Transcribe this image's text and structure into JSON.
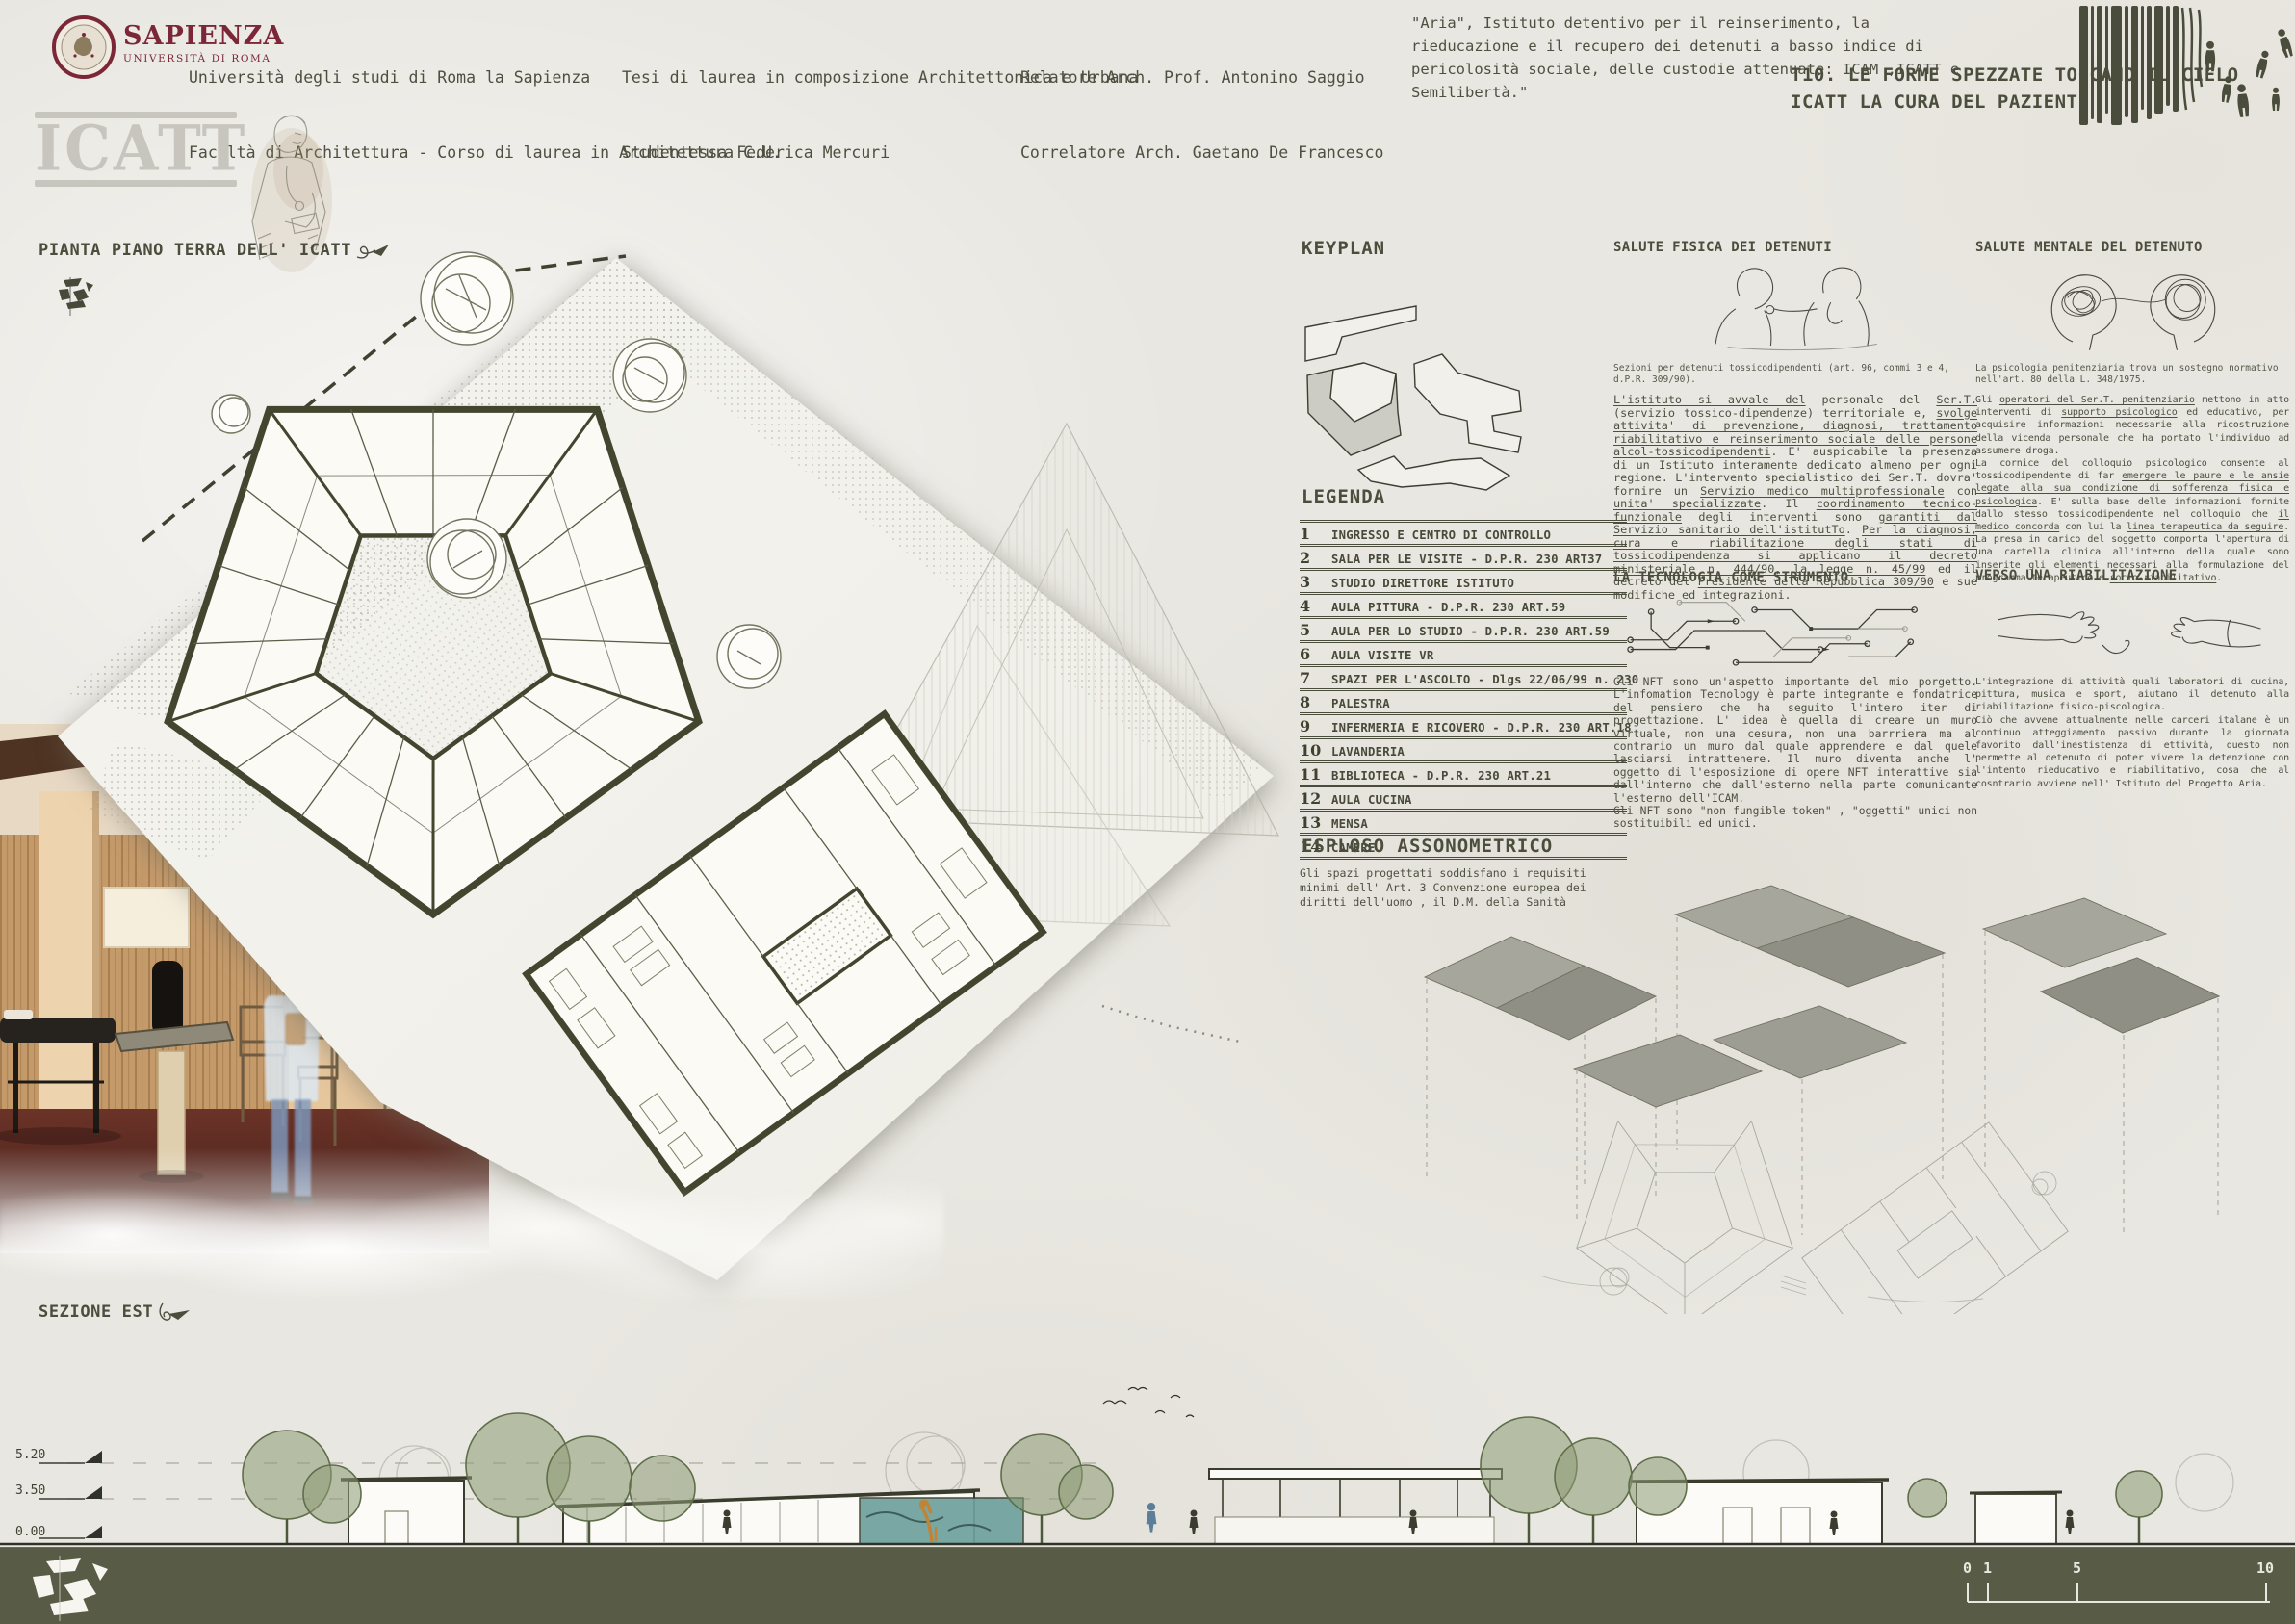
{
  "header": {
    "logo": {
      "name": "SAPIENZA",
      "subtitle": "UNIVERSITÀ DI ROMA"
    },
    "university_line1": "Università degli studi di Roma la Sapienza",
    "university_line2": "Facoltà di Architettura - Corso di laurea in Architettura C.U.",
    "thesis_line1": "Tesi di laurea in composizione Architettonica e Urbana",
    "thesis_line2": "Studentessa Federica Mercuri",
    "advisor_line1": "Relatore Arch. Prof. Antonino Saggio",
    "advisor_line2": "Correlatore Arch. Gaetano De Francesco",
    "quote": "\"Aria\",  Istituto detentivo per il reinserimento, la rieducazione  e il recupero dei detenuti a basso indice di pericolosità sociale, delle custodie attenuate: ICAM ,ICATT e Semilibertà.\"",
    "board_title_line1": "T10. LE FORME SPEZZATE TOCCANO IL CIELO",
    "board_title_line2": "ICATT LA CURA DEL PAZIENTE"
  },
  "branding": {
    "project_logo": "ICATT"
  },
  "plan": {
    "title": "PIANTA PIANO TERRA DELL' ICATT"
  },
  "keyplan": {
    "title": "KEYPLAN"
  },
  "legend": {
    "title": "LEGENDA",
    "items": [
      {
        "num": "1",
        "label": "INGRESSO E CENTRO DI CONTROLLO"
      },
      {
        "num": "2",
        "label": "SALA PER LE VISITE - D.P.R. 230 ART37"
      },
      {
        "num": "3",
        "label": "STUDIO DIRETTORE ISTITUTO"
      },
      {
        "num": "4",
        "label": "AULA PITTURA - D.P.R. 230 ART.59"
      },
      {
        "num": "5",
        "label": "AULA PER LO STUDIO - D.P.R. 230 ART.59"
      },
      {
        "num": "6",
        "label": "AULA VISITE VR"
      },
      {
        "num": "7",
        "label": "SPAZI PER L'ASCOLTO - Dlgs 22/06/99 n. 230"
      },
      {
        "num": "8",
        "label": "PALESTRA"
      },
      {
        "num": "9",
        "label": "INFERMERIA E RICOVERO - D.P.R. 230 ART.18"
      },
      {
        "num": "10",
        "label": "LAVANDERIA"
      },
      {
        "num": "11",
        "label": "BIBLIOTECA - D.P.R. 230 ART.21"
      },
      {
        "num": "12",
        "label": "AULA CUCINA"
      },
      {
        "num": "13",
        "label": "MENSA"
      },
      {
        "num": "14",
        "label": "CAMERE"
      }
    ],
    "note": "Gli spazi progettati soddisfano i requisiti minimi dell' Art. 3 Convenzione europea dei diritti dell'uomo , il D.M. della Sanità"
  },
  "axon": {
    "title": "ESPLOSO ASSONOMETRICO"
  },
  "sections_text": {
    "salute_fisica": {
      "title": "SALUTE FISICA DEI DETENUTI",
      "caption": "Sezioni per detenuti tossicodipendenti (art. 96, commi  3  e  4, d.P.R. 309/90).",
      "body": [
        [
          {
            "t": "L'istituto si avvale del",
            "u": true
          },
          {
            "t": " personale del ",
            "u": false
          },
          {
            "t": "Ser.T.",
            "u": true
          },
          {
            "t": " (servizio tossico-dipendenze) territoriale e, ",
            "u": false
          },
          {
            "t": "svolge attivita' di prevenzione, diagnosi, trattamento riabilitativo e reinserimento sociale delle persone alcol-tossicodipendenti",
            "u": true
          },
          {
            "t": ". E' auspicabile la presenza di un Istituto interamente dedicato almeno per ogni regione. L'intervento specialistico dei Ser.T. dovra' fornire un ",
            "u": false
          },
          {
            "t": "Servizio medico multiprofessionale",
            "u": true
          },
          {
            "t": " con ",
            "u": false
          },
          {
            "t": "unita' specializzate",
            "u": true
          },
          {
            "t": ". Il ",
            "u": false
          },
          {
            "t": "coordinamento tecnico-funzionale",
            "u": true
          },
          {
            "t": " degli interventi sono ",
            "u": false
          },
          {
            "t": "garantiti dal Servizio sanitario dell'istitutTo",
            "u": true
          },
          {
            "t": ". ",
            "u": false
          },
          {
            "t": "Per la diagnosi, cura e riabilitazione degli stati di tossicodipendenza si applicano il decreto ministeriale n. 444/90, la legge n. 45/99",
            "u": true
          },
          {
            "t": " ed il decreto del ",
            "u": false
          },
          {
            "t": "Presidente della Repubblica 309/90",
            "u": true
          },
          {
            "t": " e sue modifiche ed integrazioni.",
            "u": false
          }
        ]
      ]
    },
    "salute_mentale": {
      "title": "SALUTE MENTALE DEL DETENUTO",
      "caption": "La psicologia penitenziaria trova un sostegno normativo nell'art. 80 della L. 348/1975.",
      "body": [
        [
          {
            "t": "Gli ",
            "u": false
          },
          {
            "t": "operatori del Ser.T. penitenziario",
            "u": true
          },
          {
            "t": " mettono in atto interventi di ",
            "u": false
          },
          {
            "t": "supporto psicologico",
            "u": true
          },
          {
            "t": " ed educativo, per acquisire informazioni necessarie alla ricostruzione della vicenda personale che ha portato l'individuo ad assumere droga.",
            "u": false
          }
        ],
        [
          {
            "t": "La cornice del colloquio psicologico consente al tossicodipendente di far ",
            "u": false
          },
          {
            "t": "emergere le paure e le ansie legate alla sua condizione di sofferenza fisica e psicologica",
            "u": true
          },
          {
            "t": ". E' sulla base delle informazioni fornite dallo stesso tossicodipendente nel colloquio che ",
            "u": false
          },
          {
            "t": "il medico concorda",
            "u": true
          },
          {
            "t": " con lui la ",
            "u": false
          },
          {
            "t": "linea terapeutica da seguire",
            "u": true
          },
          {
            "t": ". La presa in carico del soggetto comporta l'apertura di una cartella clinica all'interno della quale sono inserite gli elementi necessari alla formulazione del programma terapeutico e ",
            "u": false
          },
          {
            "t": "socio-riabilitativo",
            "u": true
          },
          {
            "t": ".",
            "u": false
          }
        ]
      ]
    },
    "tecnologia": {
      "title": "LA TECNOLOGIA COME STRUMENTO",
      "body": [
        [
          {
            "t": "Gli NFT sono un'aspetto importante del mio porgetto. L'infomation Tecnology è parte integrante e fondatrice del pensiero che ha seguito l'intero iter di progettazione. L' idea è quella di creare un muro virtuale, non una cesura, non una barrriera ma al contrario un muro dal quale apprendere e dal quele lasciarsi intrattenere. Il muro diventa anche l' oggetto di l'esposizione di opere NFT interattive sia dall'interno che dall'esterno nella parte comunicante l'esterno dell'ICAM.",
            "u": false
          }
        ],
        [
          {
            "t": "Gli NFT sono \"non fungible token\" , \"oggetti\" unici non sostituibili ed unici.",
            "u": false
          }
        ]
      ]
    },
    "riabilitazione": {
      "title": "VERSO UNA RIABILITAZIONE",
      "body": [
        [
          {
            "t": "L'integrazione di attività quali laboratori di cucina, pittura, musica  e sport, aiutano il detenuto alla riabilitazione fisico-piscologica.",
            "u": false
          }
        ],
        [
          {
            "t": "Ciò che avvene attualmente nelle carceri italane è un continuo atteggiamento passivo durante la giornata favorito dall'inestistenza di ettività, questo non permette al detenuto di poter vivere la detenzione con l'intento rieducativo e riabilitativo, cosa che al cosntrario avviene nell' Istituto del Progetto Aria.",
            "u": false
          }
        ]
      ]
    }
  },
  "section_drawing": {
    "title": "SEZIONE EST",
    "levels": [
      "5.20",
      "3.50",
      "0.00"
    ]
  },
  "scalebar": {
    "ticks": [
      "0",
      "1",
      "5",
      "10"
    ]
  },
  "colors": {
    "paper": "#e9e7e1",
    "ink": "#4d5040",
    "plan_wall": "#43462f",
    "maroon": "#7b2737",
    "stamp_gray": "#c7c5bd",
    "footer_strip": "#585b45",
    "axon_gray": "#9d9d93",
    "mural_teal": "#6fa19e",
    "tree_green": "#5f6e4a"
  }
}
